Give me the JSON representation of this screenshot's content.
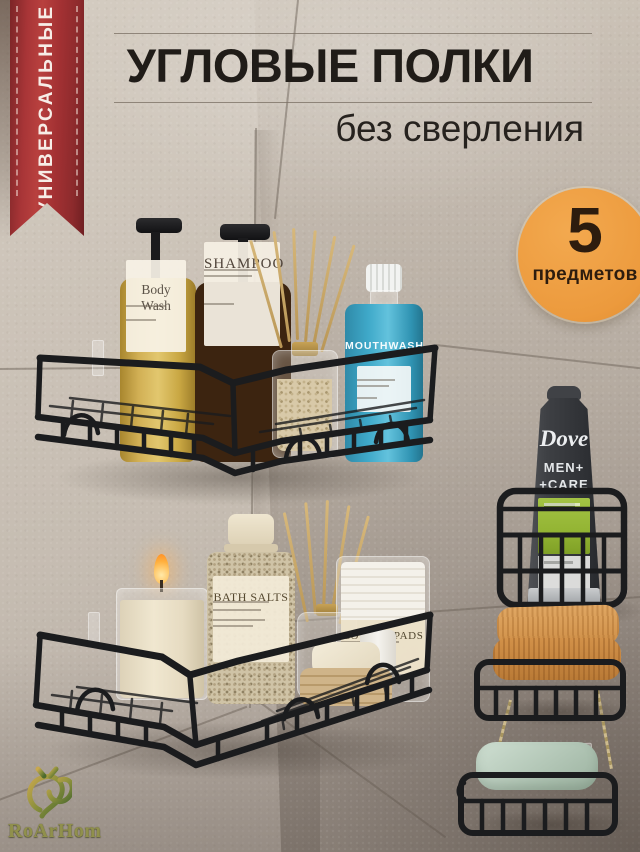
{
  "meta": {
    "width": 640,
    "height": 852,
    "kind": "marketplace product photo card"
  },
  "ribbon": {
    "label": "УНИВЕРСАЛЬНЫЕ"
  },
  "header": {
    "title": "УГЛОВЫЕ ПОЛКИ",
    "subtitle": "без сверления"
  },
  "badge": {
    "number": "5",
    "label": "предметов"
  },
  "products": {
    "body_wash": {
      "label": "Body Wash"
    },
    "shampoo": {
      "label": "SHAMPOO"
    },
    "mouthwash": {
      "label": "MOUTHWASH"
    },
    "bath_salts": {
      "label": "BATH SALTS"
    },
    "cotton_pads": {
      "label": "COTTON PADS"
    },
    "dove": {
      "brand": "Dove",
      "line1": "MEN+",
      "line2": "+CARE"
    }
  },
  "logo": {
    "text": "RoArHom"
  },
  "colors": {
    "accent-red": "#a83537",
    "badge-orange": "#ec9a3d",
    "badge-text": "#2d1c0e",
    "title-text": "#201c18",
    "wire-black": "#1b1c1e",
    "dove-green": "#93b433",
    "mouthwash-blue": "#3fa9c9",
    "logo-green": "#90904c",
    "wall": "#c9c0b5"
  }
}
